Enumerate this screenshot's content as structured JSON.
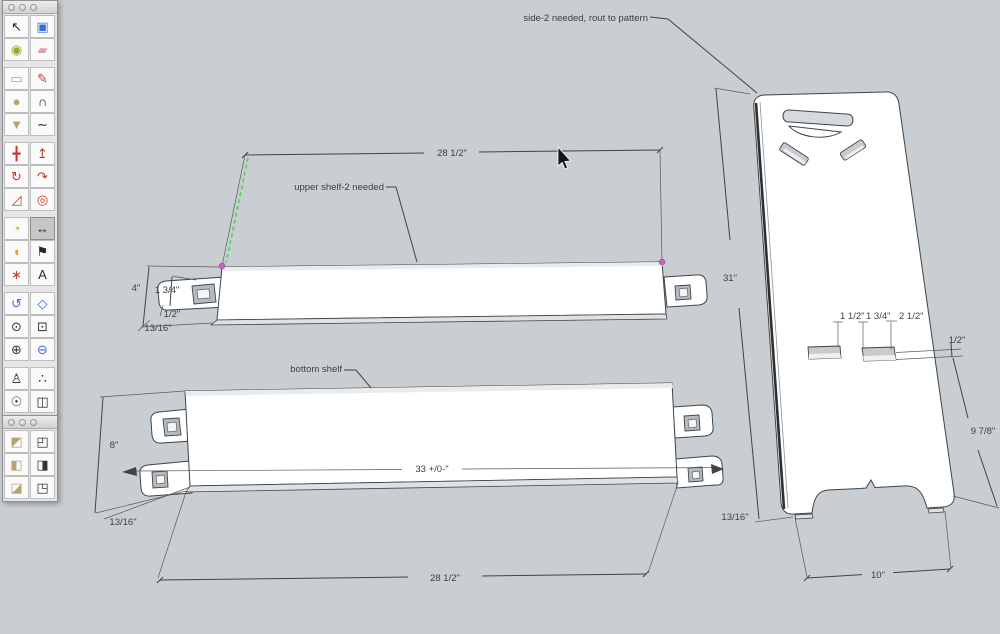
{
  "app": {
    "name": "SketchUp model window",
    "selected_tool": "dimension"
  },
  "colors": {
    "canvas_bg": "#c9ced2",
    "board_fill": "#ffffff",
    "line": "#3f4449",
    "inference_green": "#54d054",
    "endpoint_magenta": "#c95fc9",
    "selected_tool_bg": "#c6c6c6"
  },
  "palette_main": {
    "tools": [
      {
        "name": "select",
        "icon": "↖"
      },
      {
        "name": "make-component",
        "icon": "▣"
      },
      {
        "name": "paint-bucket",
        "icon": "◉"
      },
      {
        "name": "eraser",
        "icon": "▰"
      },
      {
        "name": "rectangle",
        "icon": "▭"
      },
      {
        "name": "line",
        "icon": "✎"
      },
      {
        "name": "circle",
        "icon": "●"
      },
      {
        "name": "arc",
        "icon": "∩"
      },
      {
        "name": "polygon",
        "icon": "▼"
      },
      {
        "name": "freehand",
        "icon": "∼"
      },
      {
        "name": "move",
        "icon": "╋"
      },
      {
        "name": "push-pull",
        "icon": "↥"
      },
      {
        "name": "rotate",
        "icon": "↻"
      },
      {
        "name": "follow-me",
        "icon": "↷"
      },
      {
        "name": "scale",
        "icon": "◿"
      },
      {
        "name": "offset",
        "icon": "◎"
      },
      {
        "name": "tape-measure",
        "icon": "◔"
      },
      {
        "name": "dimension",
        "icon": "↔",
        "selected": true
      },
      {
        "name": "protractor",
        "icon": "◖"
      },
      {
        "name": "text",
        "icon": "⚑"
      },
      {
        "name": "axes",
        "icon": "∗"
      },
      {
        "name": "3d-text",
        "icon": "A"
      },
      {
        "name": "orbit",
        "icon": "↺"
      },
      {
        "name": "pan",
        "icon": "◇"
      },
      {
        "name": "zoom",
        "icon": "⊙"
      },
      {
        "name": "zoom-window",
        "icon": "⊡"
      },
      {
        "name": "zoom-extents",
        "icon": "⊕"
      },
      {
        "name": "zoom-previous",
        "icon": "⊖"
      },
      {
        "name": "position-camera",
        "icon": "♙"
      },
      {
        "name": "walk",
        "icon": "∴"
      },
      {
        "name": "look-around",
        "icon": "☉"
      },
      {
        "name": "section-plane",
        "icon": "◫"
      }
    ]
  },
  "palette_views": {
    "tools": [
      {
        "name": "iso-view",
        "icon": "◩"
      },
      {
        "name": "top-view",
        "icon": "◰"
      },
      {
        "name": "front-view",
        "icon": "◧"
      },
      {
        "name": "right-view",
        "icon": "◨"
      },
      {
        "name": "back-view",
        "icon": "◪"
      },
      {
        "name": "left-view",
        "icon": "◳"
      }
    ]
  },
  "drawing": {
    "annotations": {
      "side_label": "side-2 needed, rout to pattern",
      "upper_label": "upper shelf-2 needed",
      "bottom_label": "bottom shelf"
    },
    "upper_shelf": {
      "length": "28 1/2\"",
      "height": "4\"",
      "tab": "1 3/4\"",
      "half": "1/2\"",
      "thickness": "13/16\""
    },
    "bottom_shelf": {
      "width": "8\"",
      "thickness": "13/16\"",
      "overall": "33 +/0-\"",
      "length": "28 1/2\""
    },
    "side_panel": {
      "height": "31\"",
      "slot1": "1 1/2\"",
      "slot2": "1 3/4\"",
      "slot3": "2 1/2\"",
      "slot_depth": "1/2\"",
      "lower": "9 7/8\"",
      "thickness": "13/16\"",
      "foot": "10\""
    }
  }
}
